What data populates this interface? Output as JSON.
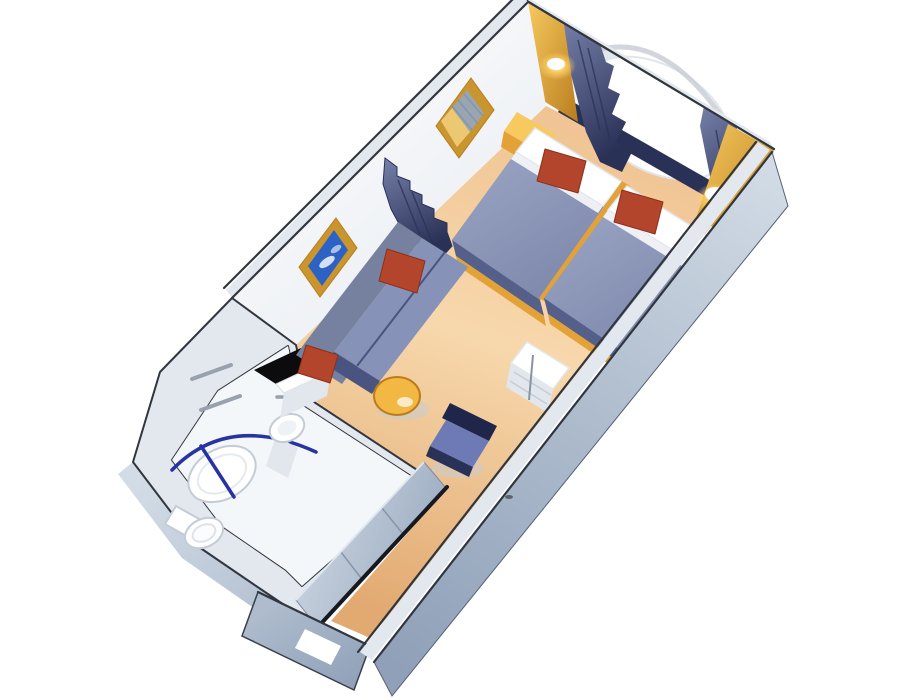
{
  "scene": {
    "items": [
      "window-wall-with-curtains",
      "porthole-window-view",
      "twin-bed-1",
      "twin-bed-2",
      "red-throw-pillows",
      "nightstand",
      "wall-mirror",
      "wall-painting",
      "privacy-curtain",
      "sofa",
      "coffee-table",
      "desk-chair",
      "desk-cabinet",
      "bathroom",
      "shower",
      "toilet",
      "sink",
      "vanity-counter",
      "towel-bars",
      "closet-sliding-doors",
      "entry-door",
      "wall-sconce-left",
      "wall-sconce-right"
    ]
  },
  "colors": {
    "bg": "#ffffff",
    "white": "#ffffff",
    "wallFaceLight": "#f4f6f9",
    "wallFaceShade": "#e8ecf2",
    "wallTopLight": "#e3e8ee",
    "wallEdgeDark": "#31363e",
    "steelLight": "#d3dce6",
    "steelMid": "#aebccd",
    "steelDark": "#8fa0b8",
    "carpetLight": "#f7d8ac",
    "carpetMid": "#f0c392",
    "carpetDark": "#e2a971",
    "gold": "#e2a238",
    "goldLight": "#f7c95e",
    "goldDark": "#b97d1e",
    "tableGold": "#f2b843",
    "glowCore": "#fff8e4",
    "glowHalo": "#ffd167",
    "navy": "#3c4677",
    "navyDark": "#2a3157",
    "curtainLight": "#7680a8",
    "blanket": "#7f89ac",
    "blanketLight": "#9ba5c4",
    "bedSkirt": "#545f8a",
    "pillowShade": "#e2e6ed",
    "red": "#b2452c",
    "redDark": "#8f3018",
    "sofa": "#76819f",
    "sofaSeat": "#8792b8",
    "sofaDark": "#4a5480",
    "chairBack": "#20264a",
    "chairSeat": "#6d7ab5",
    "artBlue": "#2b62c4",
    "frameGold": "#c9952f",
    "bathWall": "#e3e8ef",
    "bathFloor": "#f4f7fa",
    "fixtureStroke": "#c3ccd6",
    "counterBlack": "#0c0c0e",
    "rodBlue": "#2733a0",
    "metal": "#98a1ac",
    "closetPanelDark": "#9dadc2",
    "railDark": "#16191f",
    "seam": "#8695aa",
    "shadow": "#c7ccd3"
  }
}
